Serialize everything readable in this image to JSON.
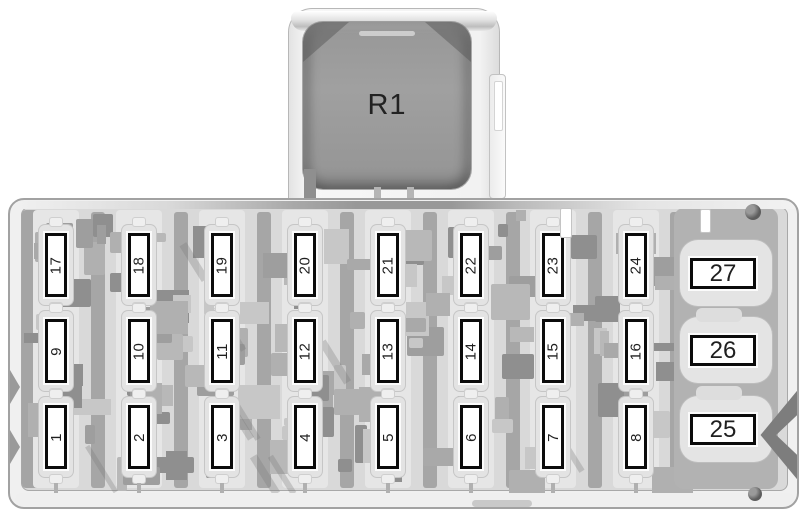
{
  "relay": {
    "label": "R1"
  },
  "fuse_grid": {
    "rows": [
      [
        "17",
        "18",
        "19",
        "20",
        "21",
        "22",
        "23",
        "24"
      ],
      [
        "9",
        "10",
        "11",
        "12",
        "13",
        "14",
        "15",
        "16"
      ],
      [
        "1",
        "2",
        "3",
        "4",
        "5",
        "6",
        "7",
        "8"
      ]
    ]
  },
  "side_fuses": [
    "27",
    "26",
    "25"
  ],
  "colors": {
    "fuse_fill": "#ffffff",
    "fuse_border": "#0b0b0b",
    "number_text": "#1f1f1f",
    "relay_fill": "#979797",
    "relay_text": "#222222",
    "panel_base": "#d9d9d9",
    "panel_rim": "#f0f0f0"
  }
}
